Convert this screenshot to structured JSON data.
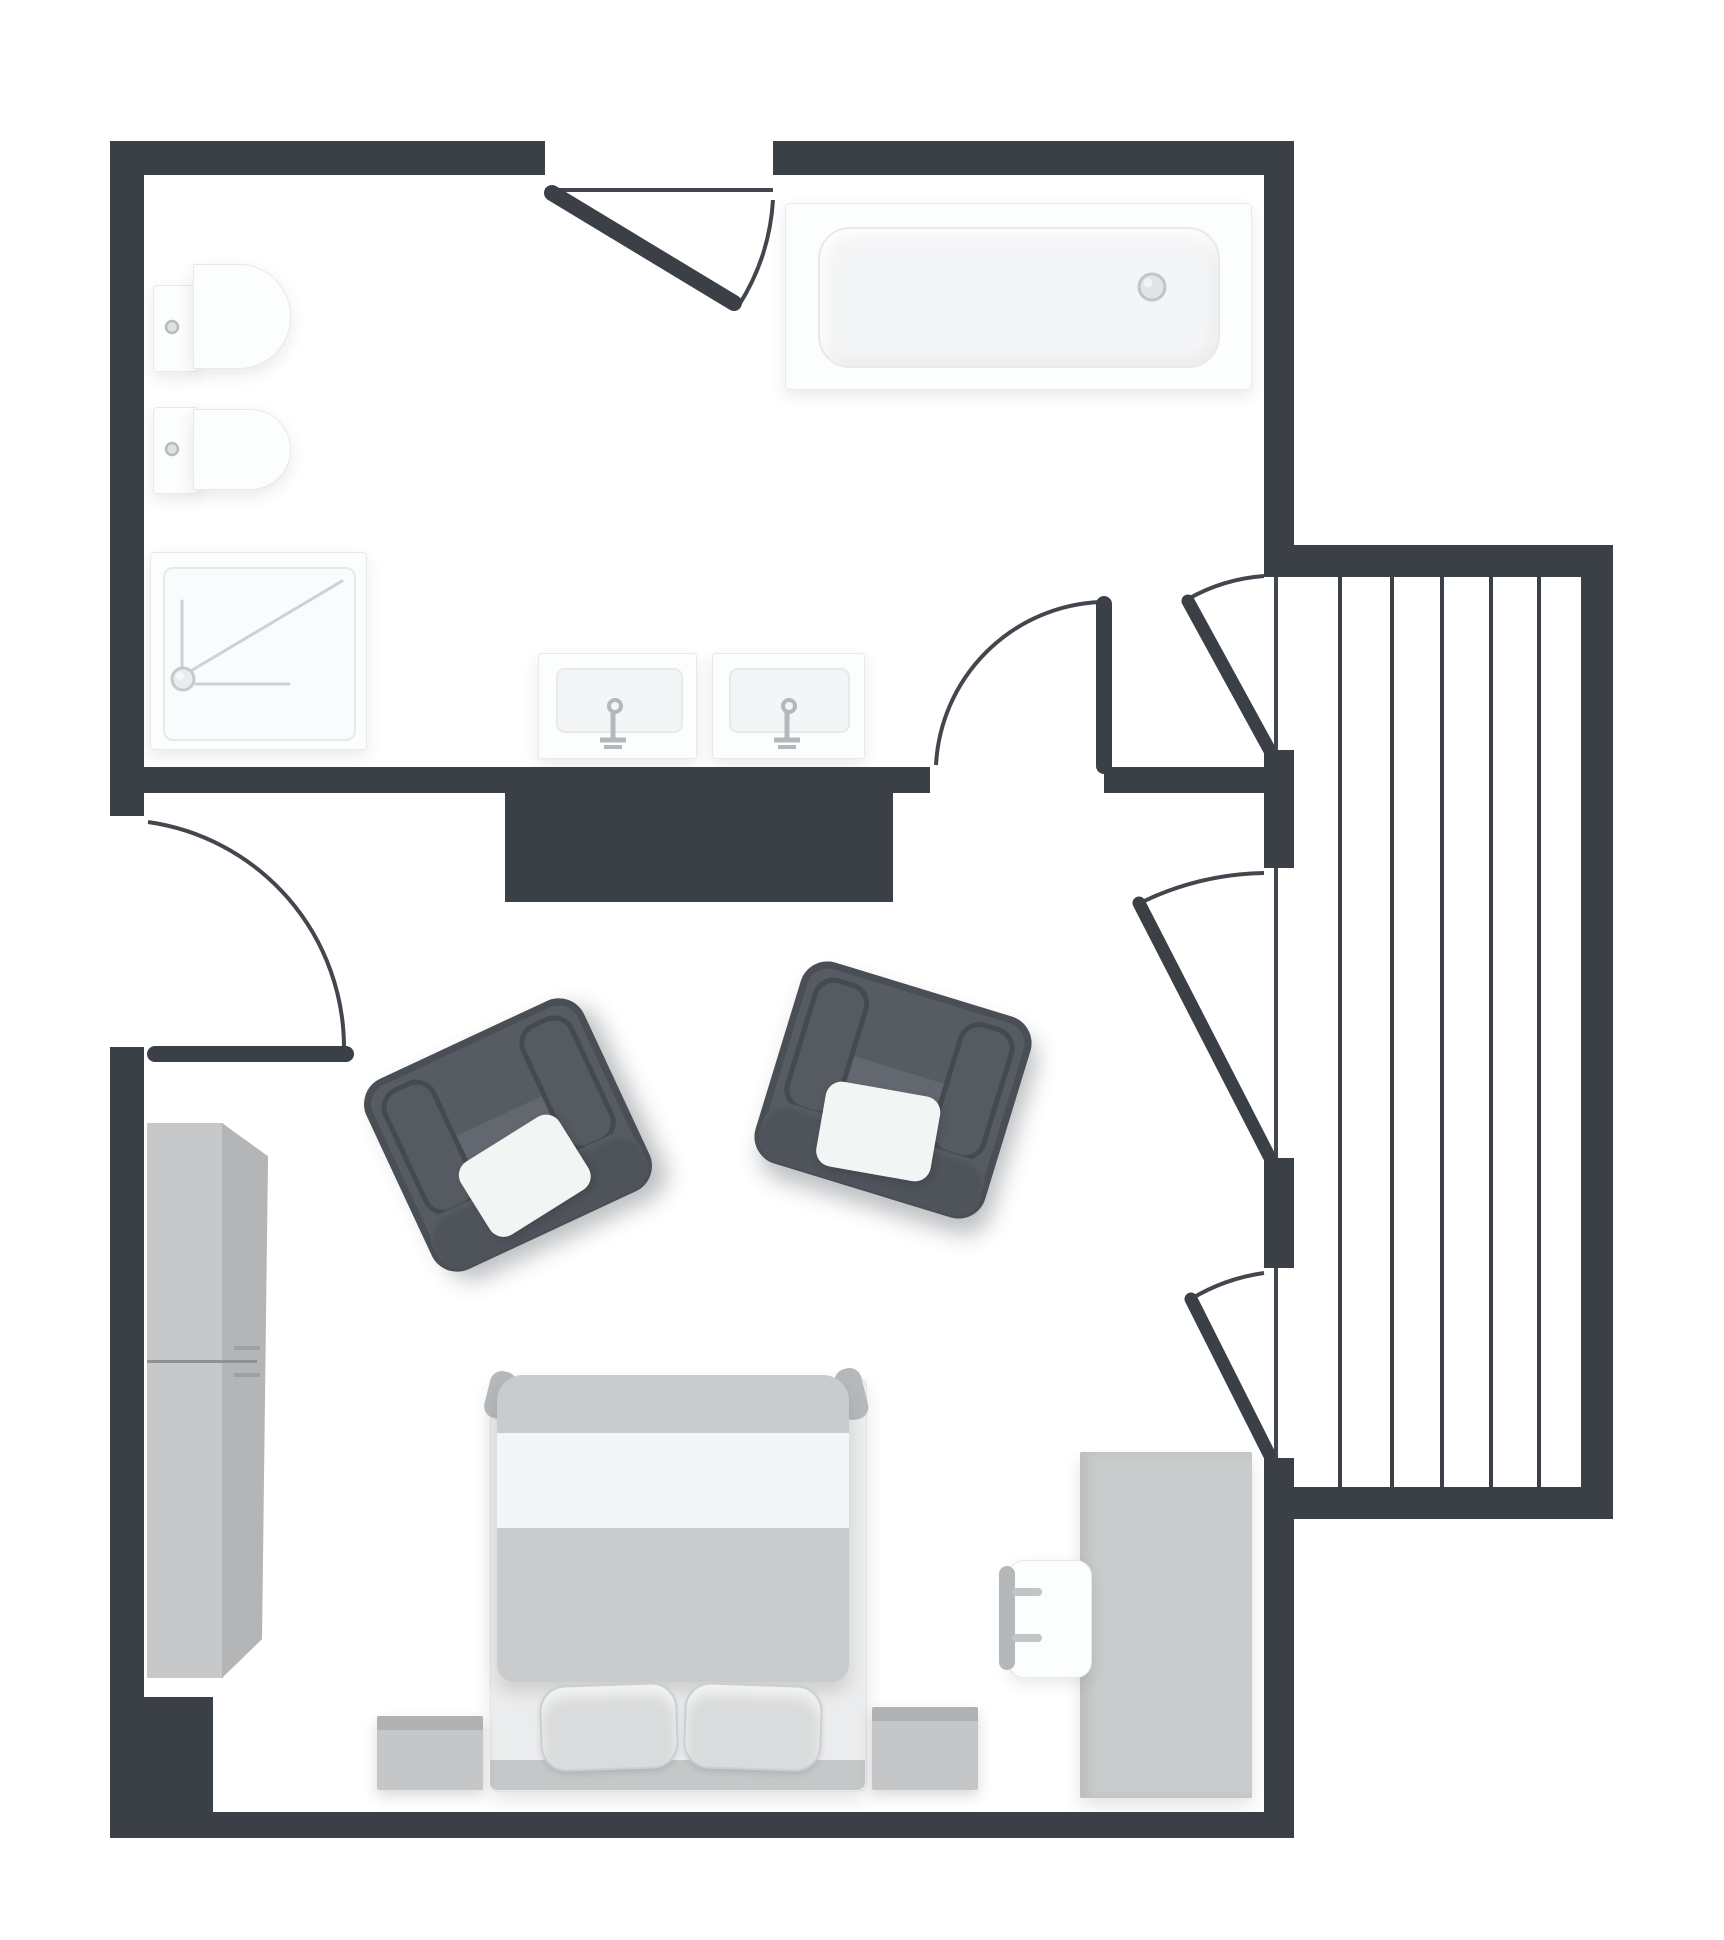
{
  "meta": {
    "type": "floor-plan",
    "description": "Top-down architectural floor plan of a studio/hotel room: bathroom at top, bedroom below, decked balcony on the right",
    "canvas": {
      "width_px": 1724,
      "height_px": 1940
    },
    "visible_text": []
  },
  "palette": {
    "wall": "#3b4046",
    "arc": "#42474d",
    "floor": "#ffffff",
    "deck-line": "#3b4046",
    "fixture-fill": "#fcfdfd",
    "fixture-border": "#e7e9eb",
    "fixture-inner": "#f4f5f6",
    "fixture-line": "#ced1d3",
    "metal": "#b4b8bb",
    "chair-body": "#575c63",
    "chair-edge": "#4a4f56",
    "chair-arm": "#565b62",
    "chair-arm-border": "#454a51",
    "chair-seat": "#636870",
    "chair-rail": "#4f545b",
    "chair-pillow": "#f3f4f4",
    "cabinet-front": "#c7c8c9",
    "cabinet-side": "#b3b5b7",
    "cabinet-line": "#8f9193",
    "bed-mattress": "#ebeced",
    "bed-duvet": "#c9cbcd",
    "bed-band": "#f4f5f7",
    "bed-strip": "#c5c7c8",
    "bed-pillow": "#d9dbdc",
    "bed-horn": "#b6b9bb",
    "table": "#c9cbcc",
    "cube": "#c5c6c7",
    "cube-top": "#b0b1b3"
  },
  "rooms": [
    {
      "name": "bathroom",
      "fixtures": [
        "toilet",
        "bidet",
        "shower",
        "double-sink-vanity",
        "bathtub"
      ]
    },
    {
      "name": "bedroom",
      "fixtures": [
        "wardrobe",
        "armchair-left",
        "armchair-right",
        "double-bed",
        "nightstand-left",
        "nightstand-right",
        "desk",
        "desk-chair"
      ]
    },
    {
      "name": "balcony",
      "fixtures": [
        "decking"
      ]
    }
  ],
  "doors": [
    {
      "name": "bathroom-top-door",
      "swing": "inward-right"
    },
    {
      "name": "entry-door-left",
      "swing": "inward-down"
    },
    {
      "name": "bathroom-inner-door",
      "swing": "up-left"
    },
    {
      "name": "balcony-door-1",
      "swing": "up-left"
    },
    {
      "name": "balcony-door-2",
      "swing": "up-left"
    },
    {
      "name": "balcony-door-3",
      "swing": "up-left"
    }
  ],
  "balcony": {
    "deck_lines_x": [
      1338,
      1390,
      1440,
      1489,
      1537
    ],
    "deck_top_y": 577,
    "deck_bottom_y": 1487,
    "plank_count": 5
  },
  "counts": {
    "toilets": 2,
    "sinks": 2,
    "armchairs": 2,
    "bed_pillows": 2,
    "nightstands": 2,
    "balcony_doors": 3
  }
}
